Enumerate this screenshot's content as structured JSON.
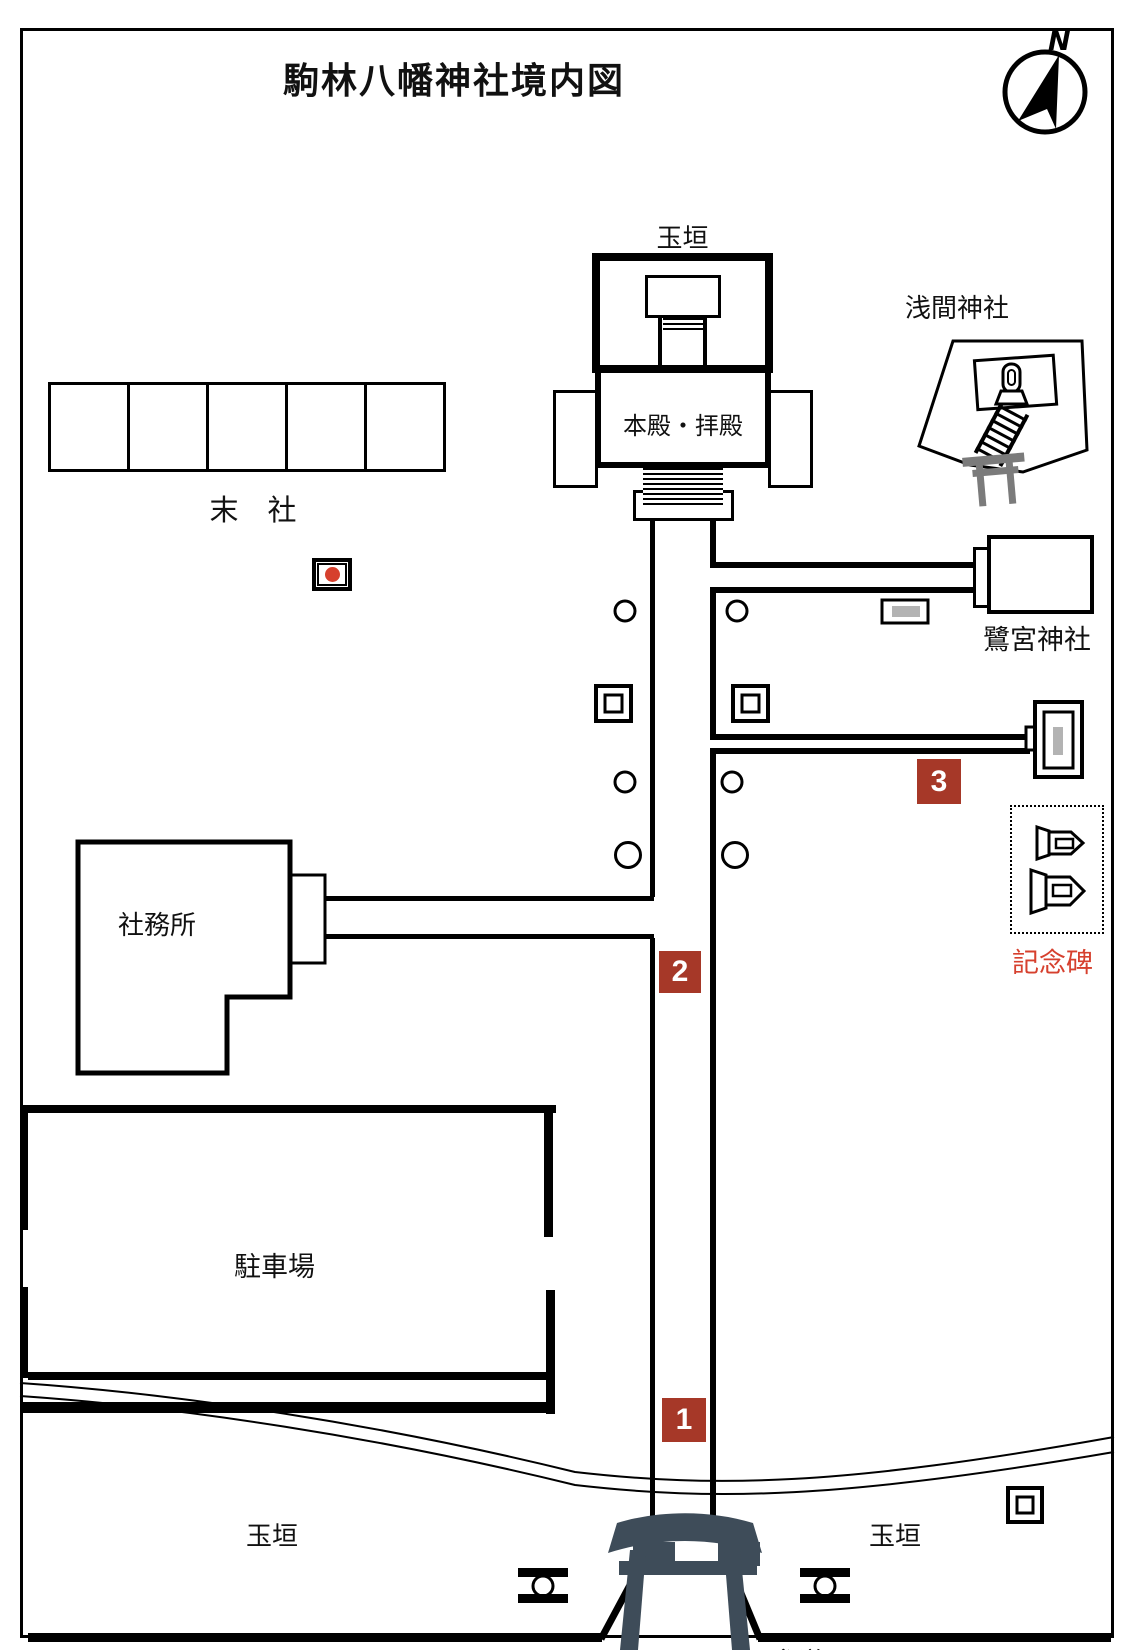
{
  "title": "駒林八幡神社境内図",
  "compass": {
    "north_label": "N"
  },
  "shrine": {
    "tamagaki_label": "玉垣",
    "honden_label": "本殿・拝殿"
  },
  "massha": {
    "label": "末　社",
    "count": 5
  },
  "sengen": {
    "label": "浅間神社"
  },
  "saginomiya": {
    "label": "鷺宮神社"
  },
  "office": {
    "label": "社務所"
  },
  "parking": {
    "label": "駐車場"
  },
  "monument_area": {
    "label": "記念碑"
  },
  "bottom": {
    "tamagaki_left": "玉垣",
    "tamagaki_right": "玉垣",
    "sando_label": "参道"
  },
  "markers": [
    {
      "number": "1"
    },
    {
      "number": "2"
    },
    {
      "number": "3"
    }
  ],
  "icons": {
    "compass": "north-compass-icon",
    "red_dot": "red-dot-marker-icon",
    "lanterns": "stone-lantern-circle-icon",
    "pedestals": "square-pedestal-icon",
    "signboard": "signboard-icon",
    "monument": "stone-monument-icon",
    "memorial_steles": "memorial-stele-icon",
    "torii_main": "torii-gate-icon",
    "torii_sengen": "small-torii-icon",
    "water_basin": "stone-basin-icon"
  },
  "colors": {
    "badge_red": "#a63828",
    "accent_red": "#d6402e",
    "torii_dark": "#3e4c59",
    "gray_fill": "#b3b3b3",
    "sengen_torii_gray": "#7b7b7b",
    "line_black": "#000000"
  }
}
